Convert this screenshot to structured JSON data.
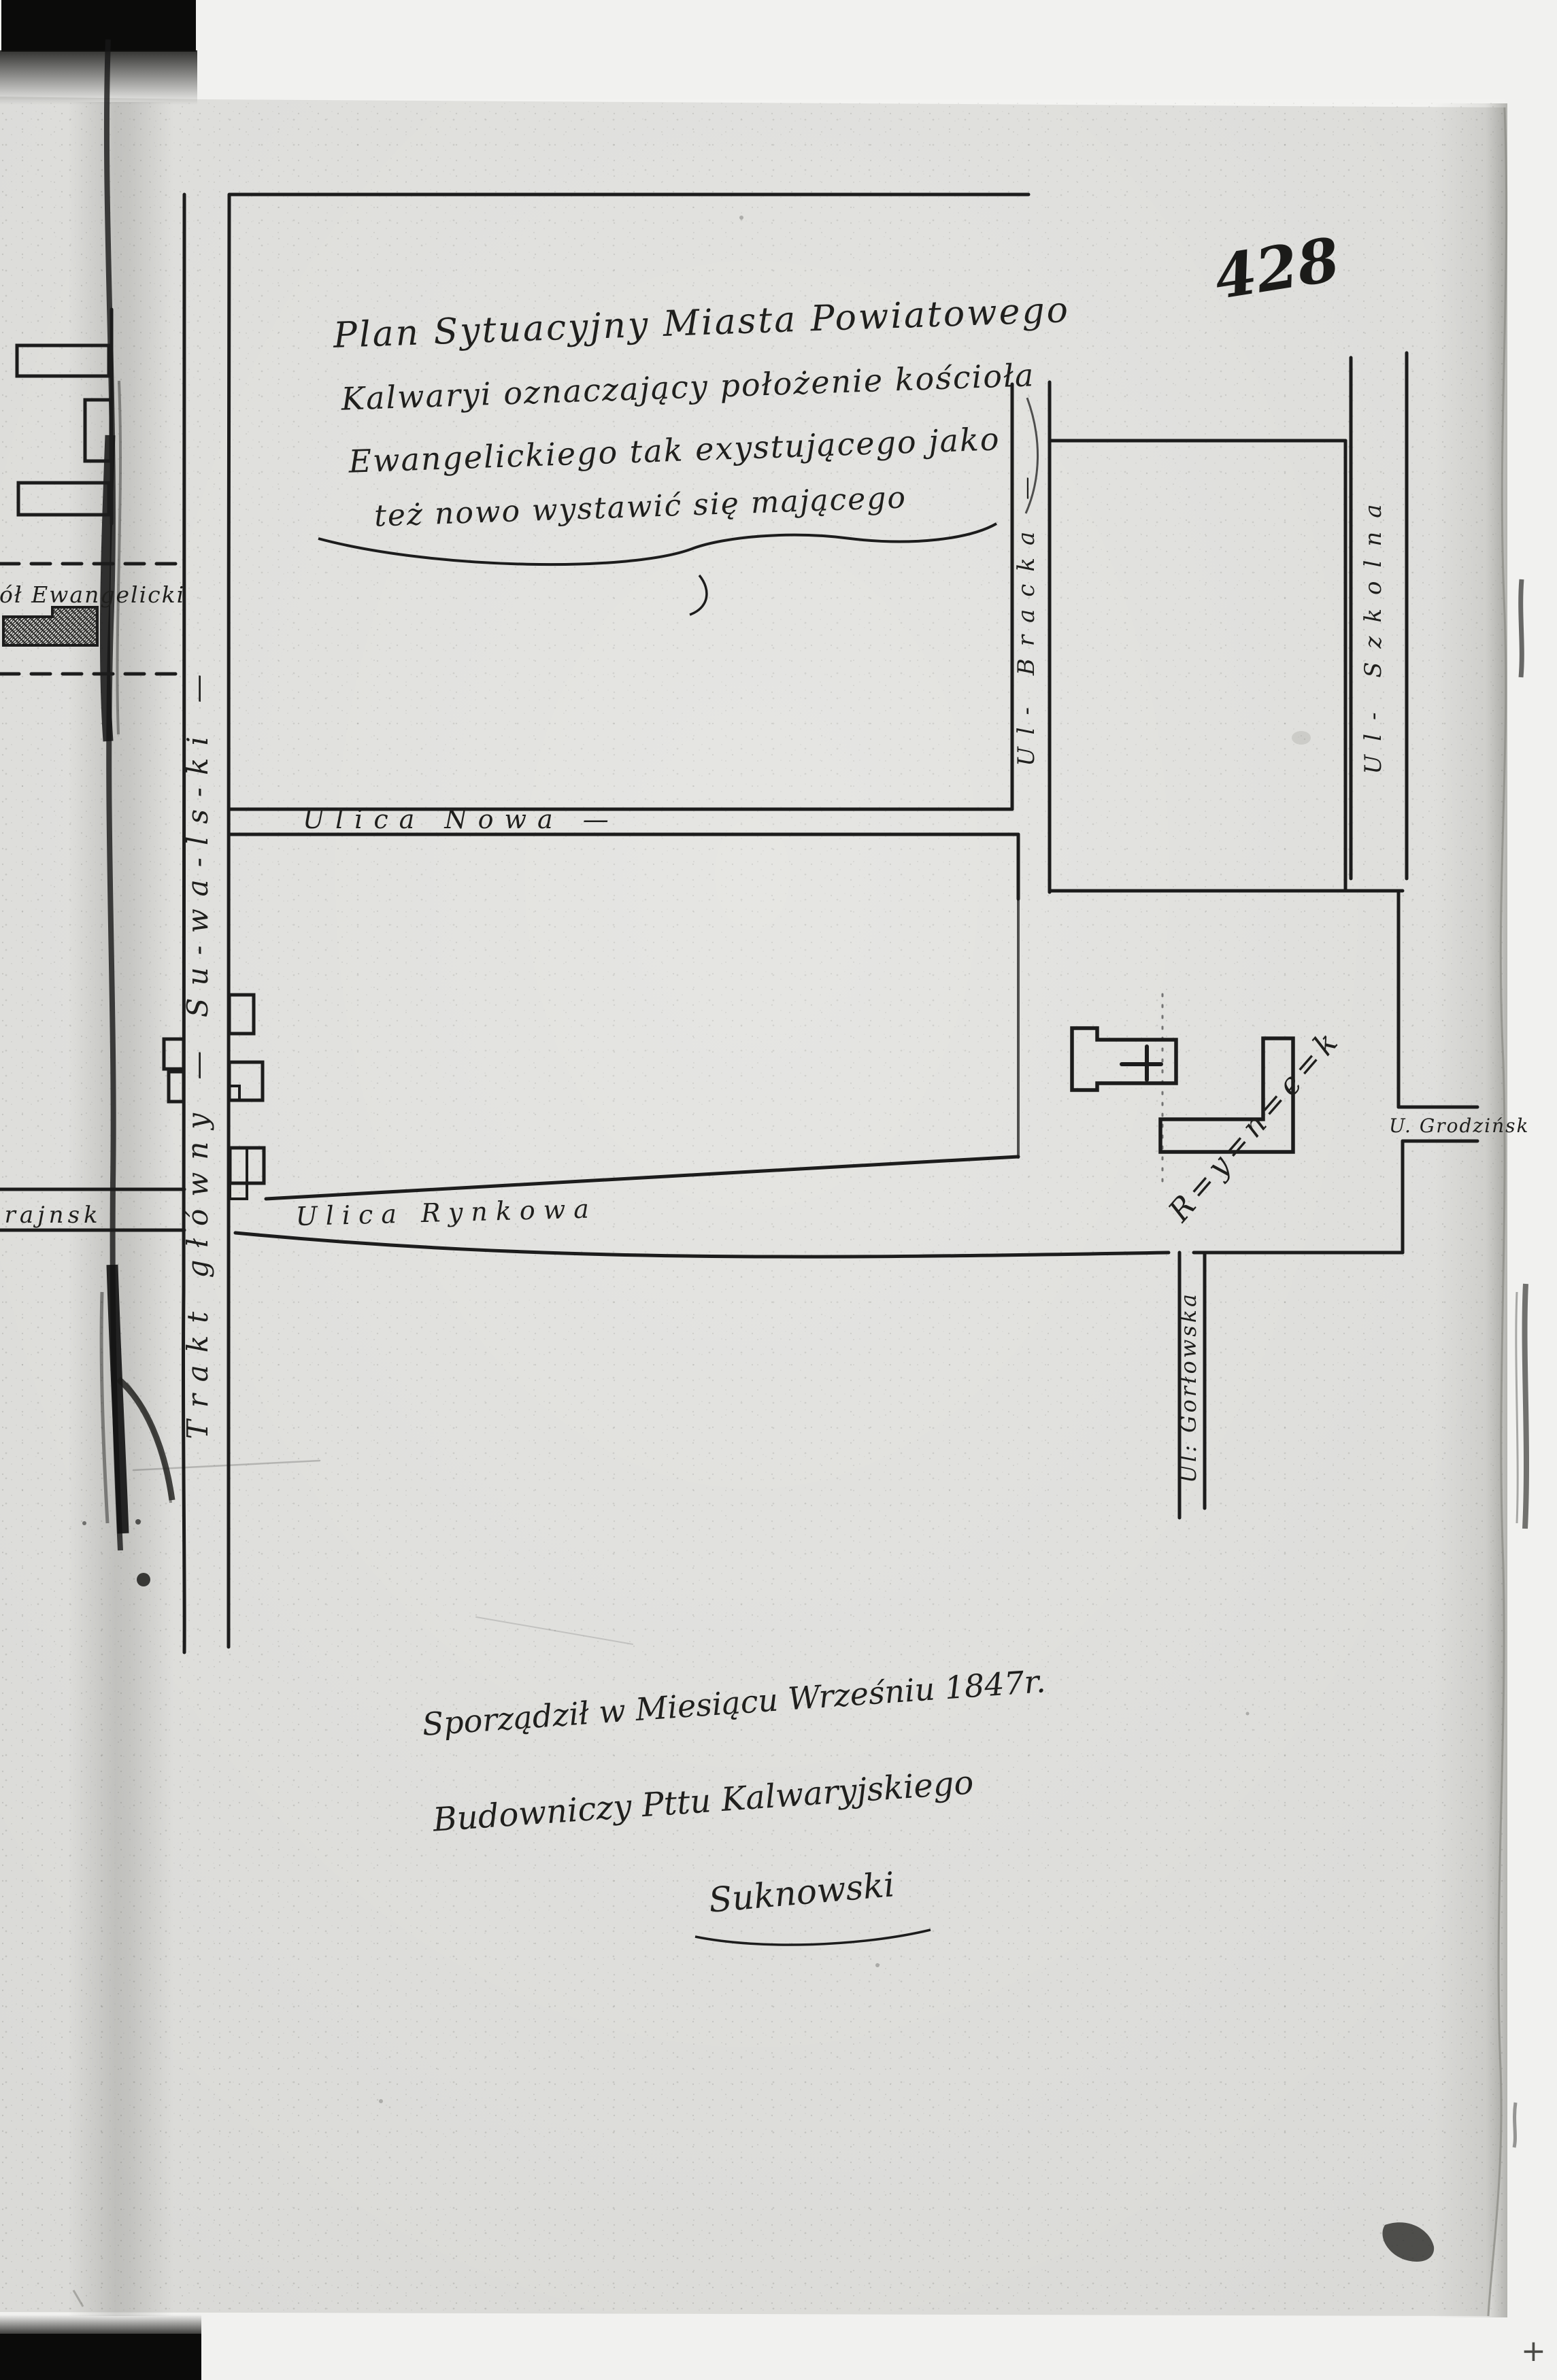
{
  "page": {
    "number": "428",
    "cross_mark": "+"
  },
  "title": {
    "line1": "Plan Sytuacyjny Miasta Powiatowego",
    "line2": "Kalwaryi oznaczający położenie kościoła",
    "line3": "Ewangelickiego tak exystującego jako",
    "line4": "też nowo wystawić się mającego"
  },
  "streets": {
    "trakt": "Trakt główny — Su-wa-ls-ki —",
    "nowa": "Ulica Nowa —",
    "rynkowa": "Ulica Rynkowa",
    "bracka": "Ul- Bracka —",
    "szkolna": "Ul- Szkolna",
    "gorlowska": "Ul: Gorłowska",
    "grodzinska": "U. Grodzińsk",
    "skrajna_fragment": "krajnsk"
  },
  "labels": {
    "kosciol_fragment": "ciół Ewangelicki",
    "rynek": "R=y=n=e=k"
  },
  "signature": {
    "line1": "Sporządził w Miesiącu Wrześniu 1847r.",
    "line2": "Budowniczy Pttu Kalwaryjskiego",
    "line3": "Suknowski"
  },
  "colors": {
    "ink": "#1c1c1c",
    "paper": "#dadad7",
    "background": "#f1f1ef"
  }
}
